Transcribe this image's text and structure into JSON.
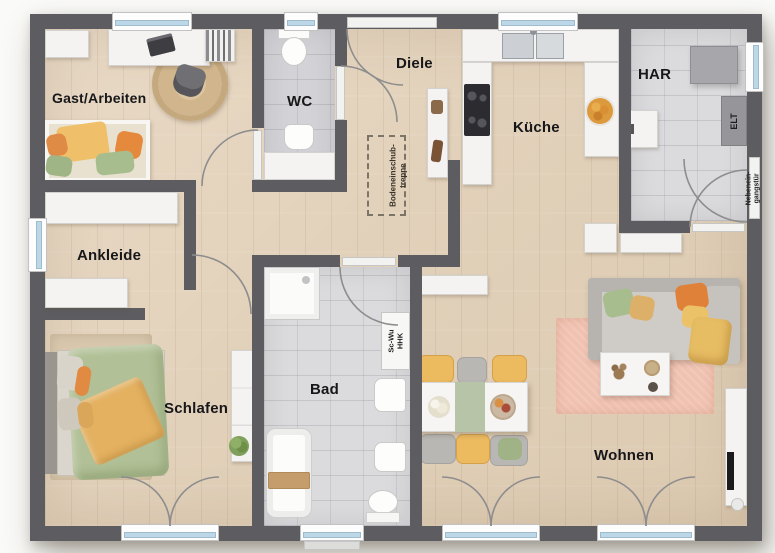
{
  "plan_title": "Bungalow Grundriss",
  "rooms": {
    "gast": {
      "label": "Gast/Arbeiten"
    },
    "wc": {
      "label": "WC"
    },
    "diele": {
      "label": "Diele"
    },
    "kueche": {
      "label": "Küche"
    },
    "har": {
      "label": "HAR"
    },
    "ankleide": {
      "label": "Ankleide"
    },
    "schlafen": {
      "label": "Schlafen"
    },
    "bad": {
      "label": "Bad"
    },
    "wohnen": {
      "label": "Wohnen"
    }
  },
  "annotations": {
    "attic_stairs": {
      "line1": "Bodeneinschub-",
      "line2": "treppe"
    },
    "elt": {
      "label": "ELT"
    },
    "side_door": {
      "line1": "Nebenein-",
      "line2": "gangstür"
    },
    "shaft": {
      "line1": "Sc-Wu",
      "line2": "HHK"
    }
  },
  "colors": {
    "wall": "#5d5d61",
    "wood_floor": "#e2d1ba",
    "tile_floor": "#dbdbde",
    "window_glass": "#bcd7e8",
    "rug_pink": "#f2c3b2",
    "duvet_green": "#b0c096",
    "blanket_yellow": "#e5b561",
    "pillow_orange": "#e0813a",
    "chair_yellow": "#ecba5f"
  }
}
